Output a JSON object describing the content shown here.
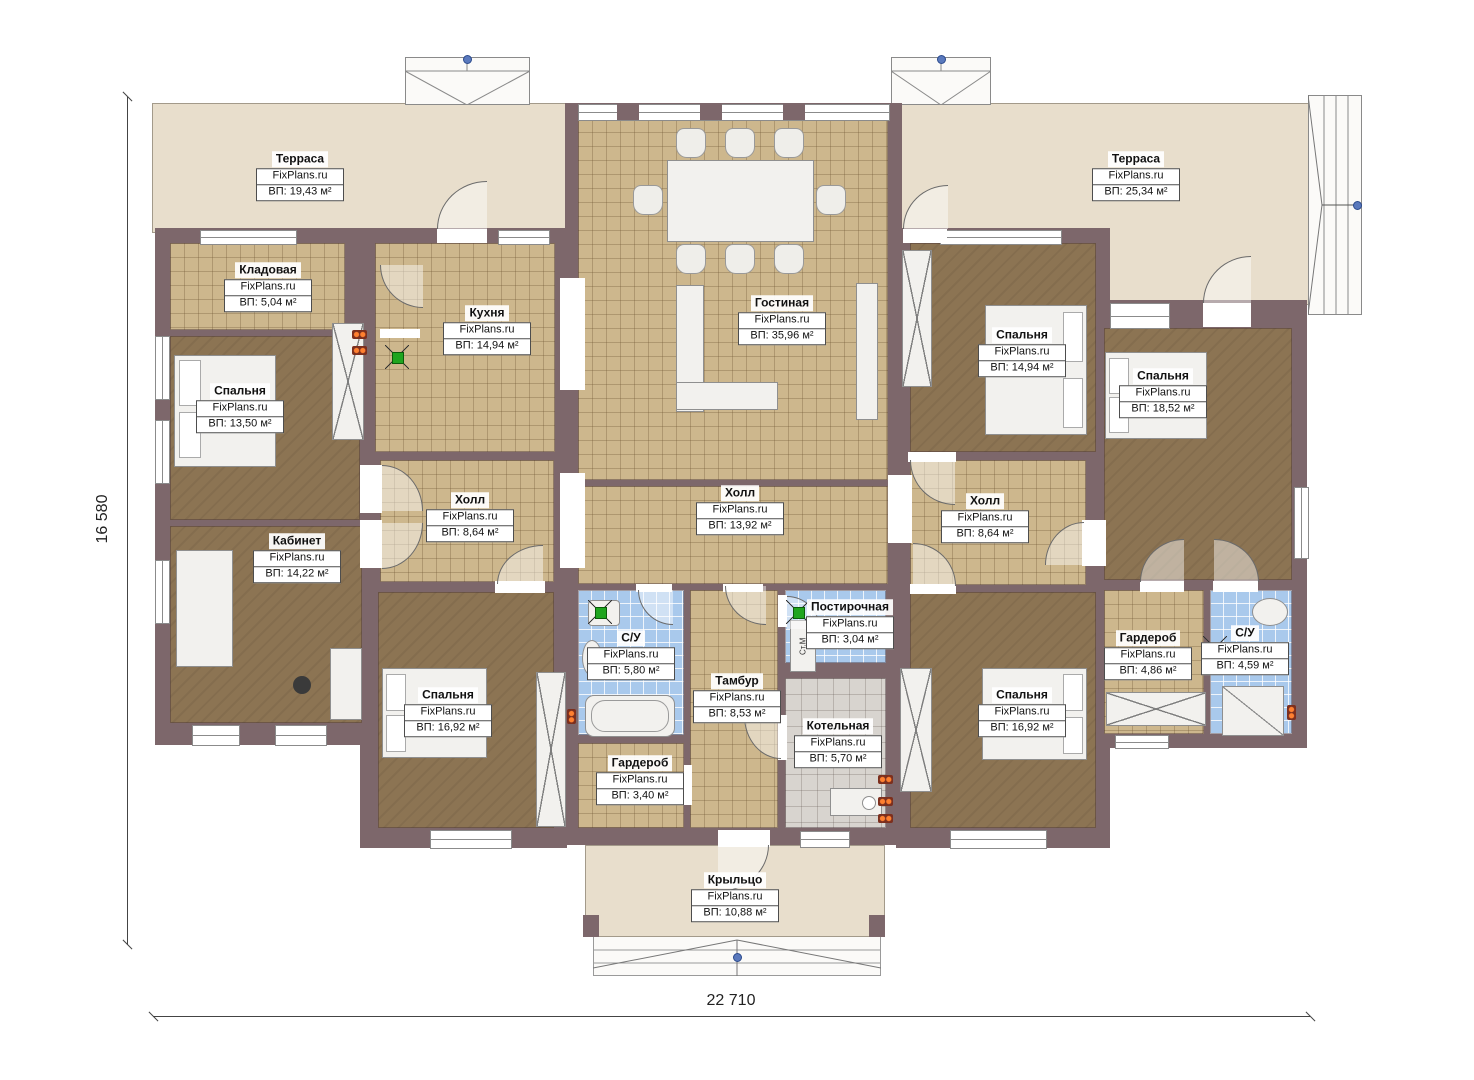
{
  "plan": {
    "watermark": "FixPlans.ru",
    "dim_width": "22 710",
    "dim_height": "16 580",
    "washer_label": "Ст.М",
    "rooms": {
      "terrace_left": {
        "name": "Терраса",
        "area": "ВП: 19,43 м²"
      },
      "terrace_right": {
        "name": "Терраса",
        "area": "ВП: 25,34 м²"
      },
      "storeroom": {
        "name": "Кладовая",
        "area": "ВП: 5,04 м²"
      },
      "kitchen": {
        "name": "Кухня",
        "area": "ВП: 14,94 м²"
      },
      "living": {
        "name": "Гостиная",
        "area": "ВП: 35,96 м²"
      },
      "bedroom_top_left": {
        "name": "Спальня",
        "area": "ВП: 13,50 м²"
      },
      "bedroom_right_1": {
        "name": "Спальня",
        "area": "ВП: 14,94 м²"
      },
      "bedroom_right_2": {
        "name": "Спальня",
        "area": "ВП: 18,52 м²"
      },
      "hall_left": {
        "name": "Холл",
        "area": "ВП: 8,64 м²"
      },
      "hall_center": {
        "name": "Холл",
        "area": "ВП: 13,92 м²"
      },
      "hall_right": {
        "name": "Холл",
        "area": "ВП: 8,64 м²"
      },
      "cabinet": {
        "name": "Кабинет",
        "area": "ВП: 14,22 м²"
      },
      "bedroom_bottom_left": {
        "name": "Спальня",
        "area": "ВП: 16,92 м²"
      },
      "bathroom_left": {
        "name": "С/У",
        "area": "ВП: 5,80 м²"
      },
      "vestibule": {
        "name": "Тамбур",
        "area": "ВП: 8,53 м²"
      },
      "laundry": {
        "name": "Постирочная",
        "area": "ВП: 3,04 м²"
      },
      "boiler": {
        "name": "Котельная",
        "area": "ВП: 5,70 м²"
      },
      "wardrobe_center": {
        "name": "Гардероб",
        "area": "ВП: 3,40 м²"
      },
      "bedroom_bottom_right": {
        "name": "Спальня",
        "area": "ВП: 16,92 м²"
      },
      "wardrobe_right": {
        "name": "Гардероб",
        "area": "ВП: 4,86 м²"
      },
      "bathroom_right": {
        "name": "С/У",
        "area": "ВП: 4,59 м²"
      },
      "porch": {
        "name": "Крыльцо",
        "area": "ВП: 10,88 м²"
      }
    },
    "colors": {
      "wall": "#7d676b",
      "tile": "#cdb78d",
      "wood": "#8c7453",
      "bath": "#a9c9ec",
      "grey_tile": "#d8d4cf",
      "terrace": "#e8decc",
      "accent_green": "#1fa51f",
      "accent_orange": "#ff8030"
    }
  }
}
